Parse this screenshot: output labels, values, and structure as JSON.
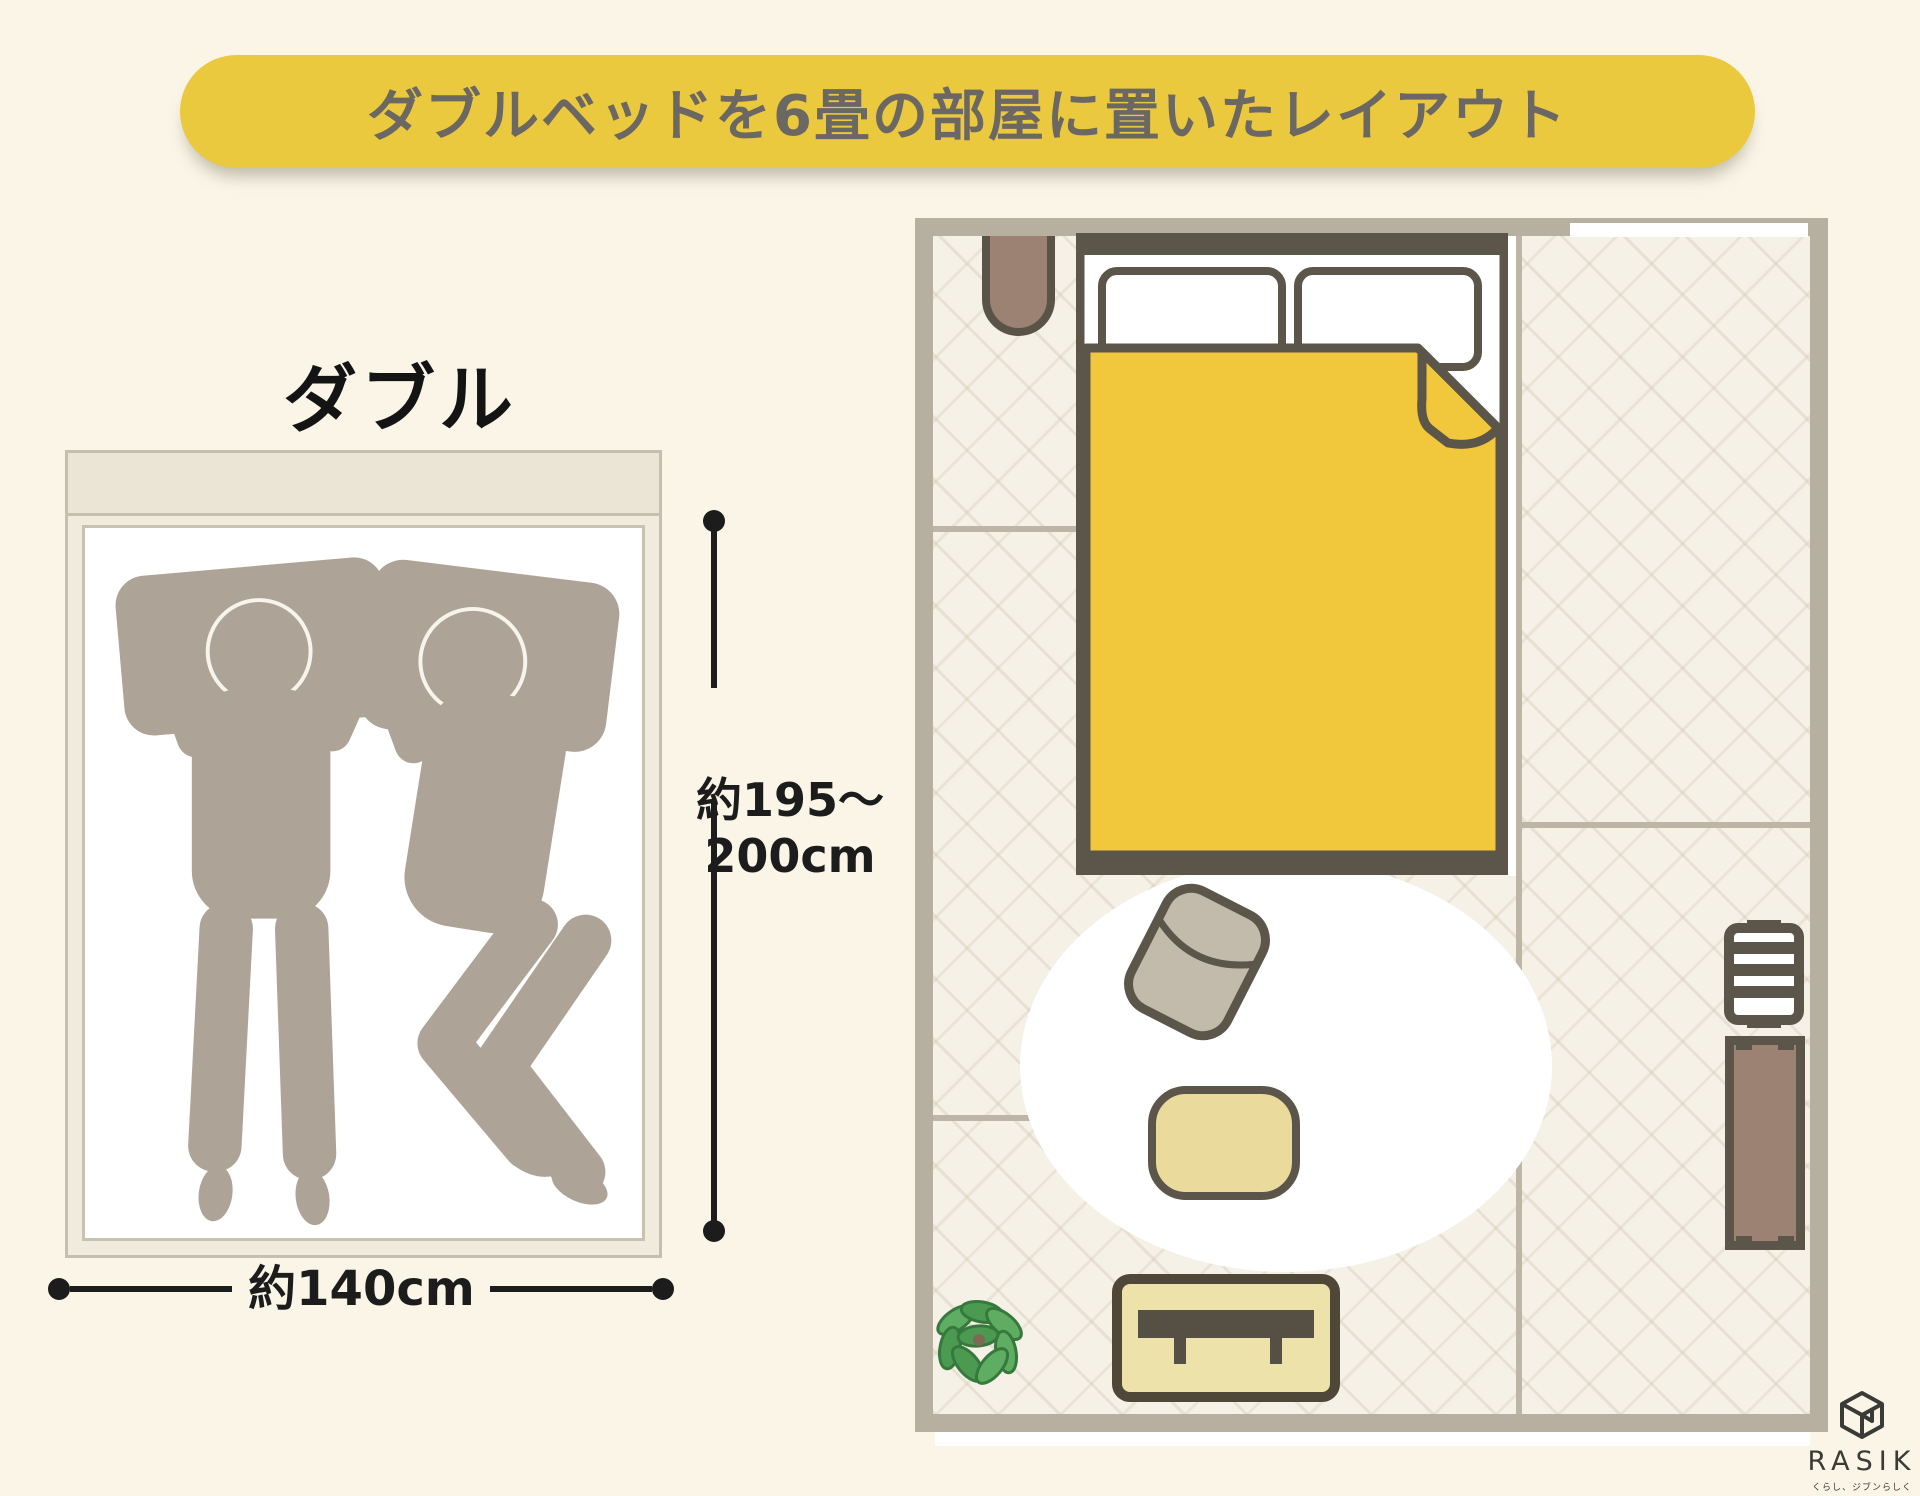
{
  "banner": {
    "title": "ダブルベッドを6畳の部屋に置いたレイアウト",
    "bg_color": "#EBC93F",
    "text_color": "#6B6762"
  },
  "bed_diagram": {
    "label": "ダブル",
    "length_line1": "約195〜",
    "length_line2": "200cm",
    "width_label": "約140cm",
    "sleepers": 2,
    "silhouette_color": "#ADA497"
  },
  "floor_plan": {
    "room_type": "6畳",
    "wall_color": "#B7AFA0",
    "floor_color": "#F6F1E7",
    "outline_color": "#5C564A",
    "blanket_color": "#F1C83C",
    "items": [
      "double-bed",
      "pillow",
      "duvet-folded-corner",
      "wall-light",
      "round-rug",
      "floor-cushion",
      "low-table",
      "tv-board",
      "plant",
      "slatted-rack",
      "chest"
    ]
  },
  "logo": {
    "name": "RASIK",
    "tagline": "くらし、ジブンらしく"
  }
}
